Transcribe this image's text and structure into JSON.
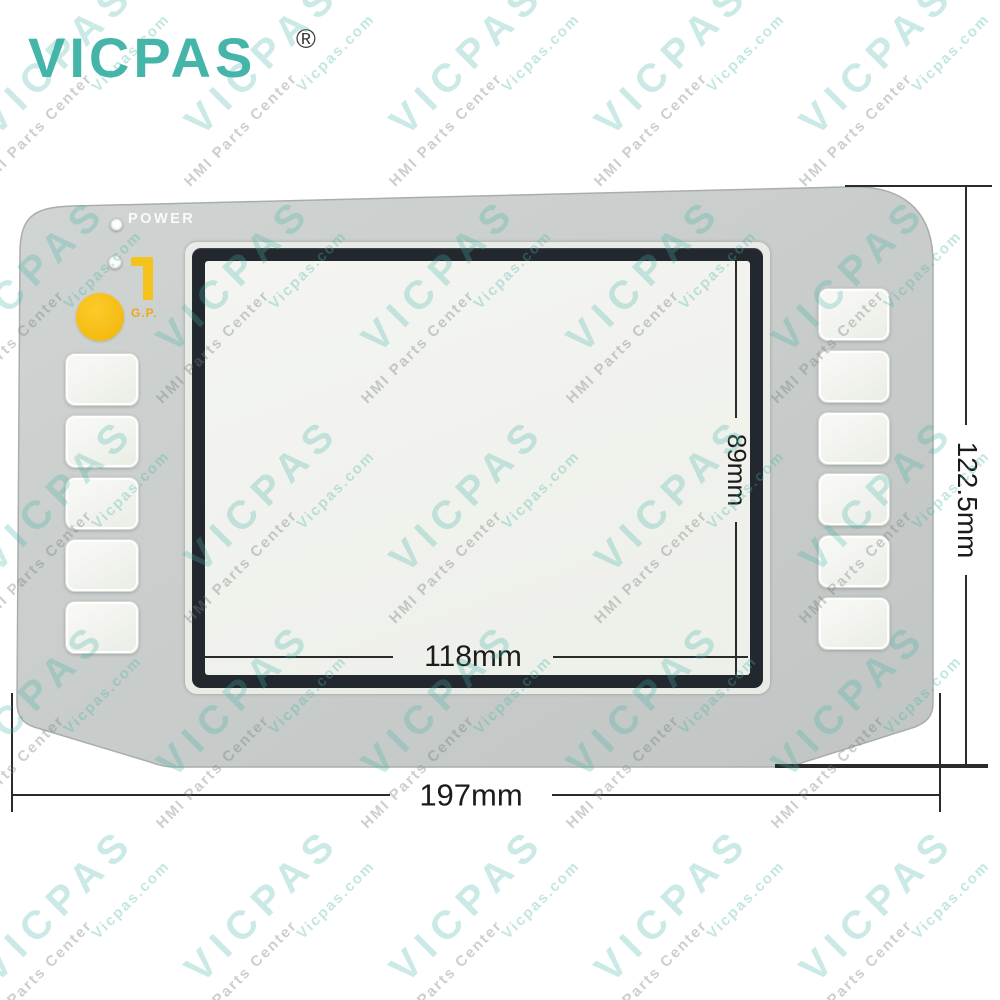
{
  "brand": {
    "logo_text": "VICPAS",
    "registered_mark": "®"
  },
  "watermark": {
    "brand_text": "VICPAS",
    "site_text": "Vicpas.com",
    "tagline_text": "HMI Parts Center"
  },
  "panel": {
    "power_label": "POWER",
    "gp_label": "G.P.",
    "left_key_count": 5,
    "right_key_count": 6
  },
  "dimensions": {
    "display_height": "89mm",
    "display_width": "118mm",
    "overall_width": "197mm",
    "overall_height": "122.5mm"
  },
  "colors": {
    "brand_teal": "#45b5a9",
    "panel_gray": "#c9cdcb",
    "key_white": "#f3f4f0",
    "accent_yellow": "#f5c31d",
    "gp_orange": "#efa816",
    "screen_frame": "#23272e",
    "display_white": "#f1f2ee",
    "dimension_ink": "#1b1b1b"
  }
}
